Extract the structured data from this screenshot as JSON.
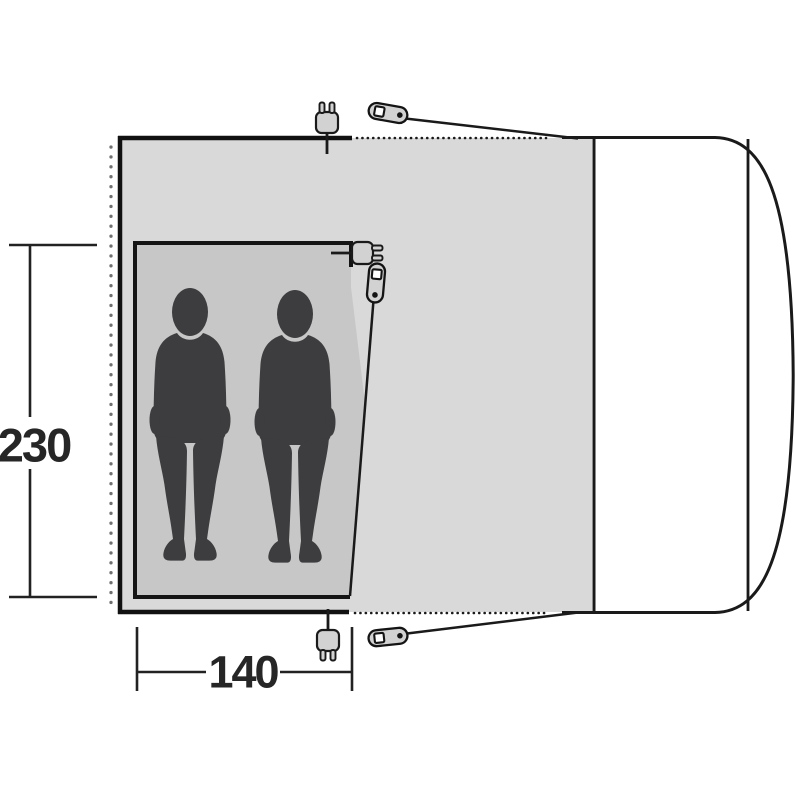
{
  "diagram": {
    "kind": "awning-floorplan-top-view",
    "dimension_labels": {
      "depth": "230",
      "width": "140"
    },
    "capacity_persons": 2,
    "colors": {
      "background": "#ffffff",
      "awning_fill": "#d9d9d9",
      "cabin_fill": "#c7c7c7",
      "silhouette": "#3d3d3f",
      "outline": "#1a1a1a",
      "border_heavy": "#141414",
      "hardware_fill": "#d2d2d2",
      "dot_column": "#707070",
      "label_text": "#262626",
      "vehicle_fill": "#ffffff"
    },
    "icons": [
      {
        "name": "power-plug-top-icon",
        "glyph": "mains-plug"
      },
      {
        "name": "peg-top-right-icon",
        "glyph": "tent-peg"
      },
      {
        "name": "power-plug-cabin-icon",
        "glyph": "mains-plug"
      },
      {
        "name": "peg-cabin-icon",
        "glyph": "tent-peg"
      },
      {
        "name": "power-plug-bottom-icon",
        "glyph": "mains-plug"
      },
      {
        "name": "peg-bottom-right-icon",
        "glyph": "tent-peg"
      }
    ]
  }
}
